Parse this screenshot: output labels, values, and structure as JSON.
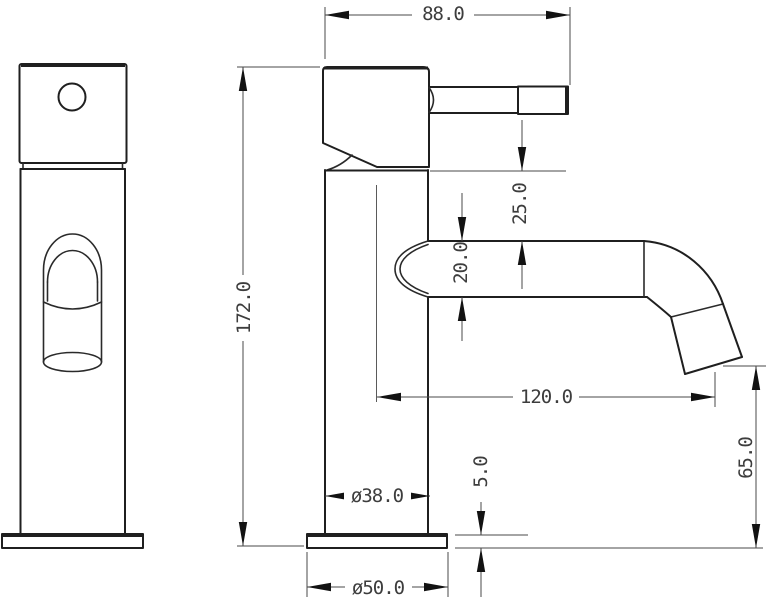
{
  "drawing": {
    "colors": {
      "background": "#ffffff",
      "outline": "#1f1f1f",
      "dimension_line": "#4a4a4a",
      "dimension_text": "#3d3d3d"
    },
    "dimensions": {
      "overall_width": "88.0",
      "overall_height": "172.0",
      "body_top_to_spout": "25.0",
      "spout_diameter": "20.0",
      "spout_reach": "120.0",
      "outlet_height": "65.0",
      "base_thickness": "5.0",
      "body_diameter": "ø38.0",
      "base_diameter": "ø50.0"
    }
  }
}
